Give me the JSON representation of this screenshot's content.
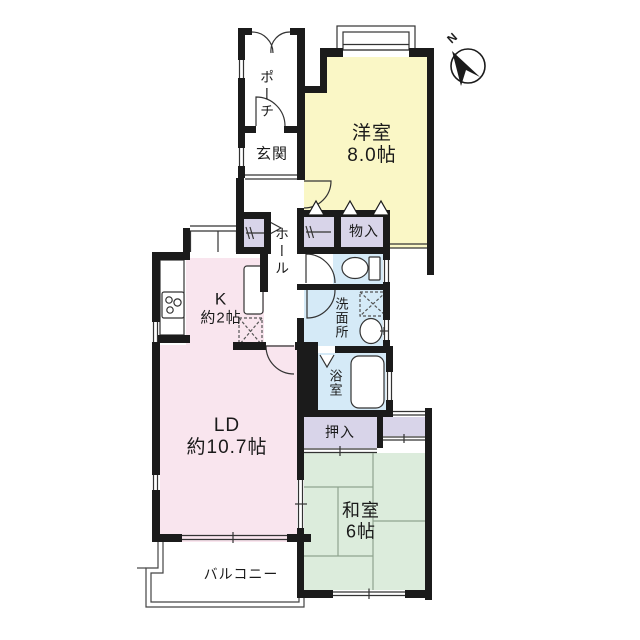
{
  "title": "apartment-floor-plan",
  "colors": {
    "wall": "#1b1b1b",
    "outline": "#333333",
    "western_room": "#FAF7C6",
    "living_dining": "#F9E5EE",
    "japanese_room": "#DCECDC",
    "closet": "#D8D4E9",
    "wet_area": "#D5EAF7",
    "tatami_line": "#8FA48F",
    "white": "#ffffff"
  },
  "compass": {
    "label": "N"
  },
  "rooms": {
    "western": {
      "name": "洋室",
      "size": "8.0帖"
    },
    "entrance": {
      "name": "玄関"
    },
    "porch": {
      "name": "ポーチ"
    },
    "hall": {
      "name": "ホール"
    },
    "storage": {
      "name": "物入"
    },
    "washroom": {
      "name": "洗面所"
    },
    "bathroom": {
      "name": "浴室"
    },
    "kitchen": {
      "name": "K",
      "size": "約2帖"
    },
    "living": {
      "name": "LD",
      "size": "約10.7帖"
    },
    "closet": {
      "name": "押入"
    },
    "japanese": {
      "name": "和室",
      "size": "6帖"
    },
    "balcony": {
      "name": "バルコニー"
    }
  }
}
